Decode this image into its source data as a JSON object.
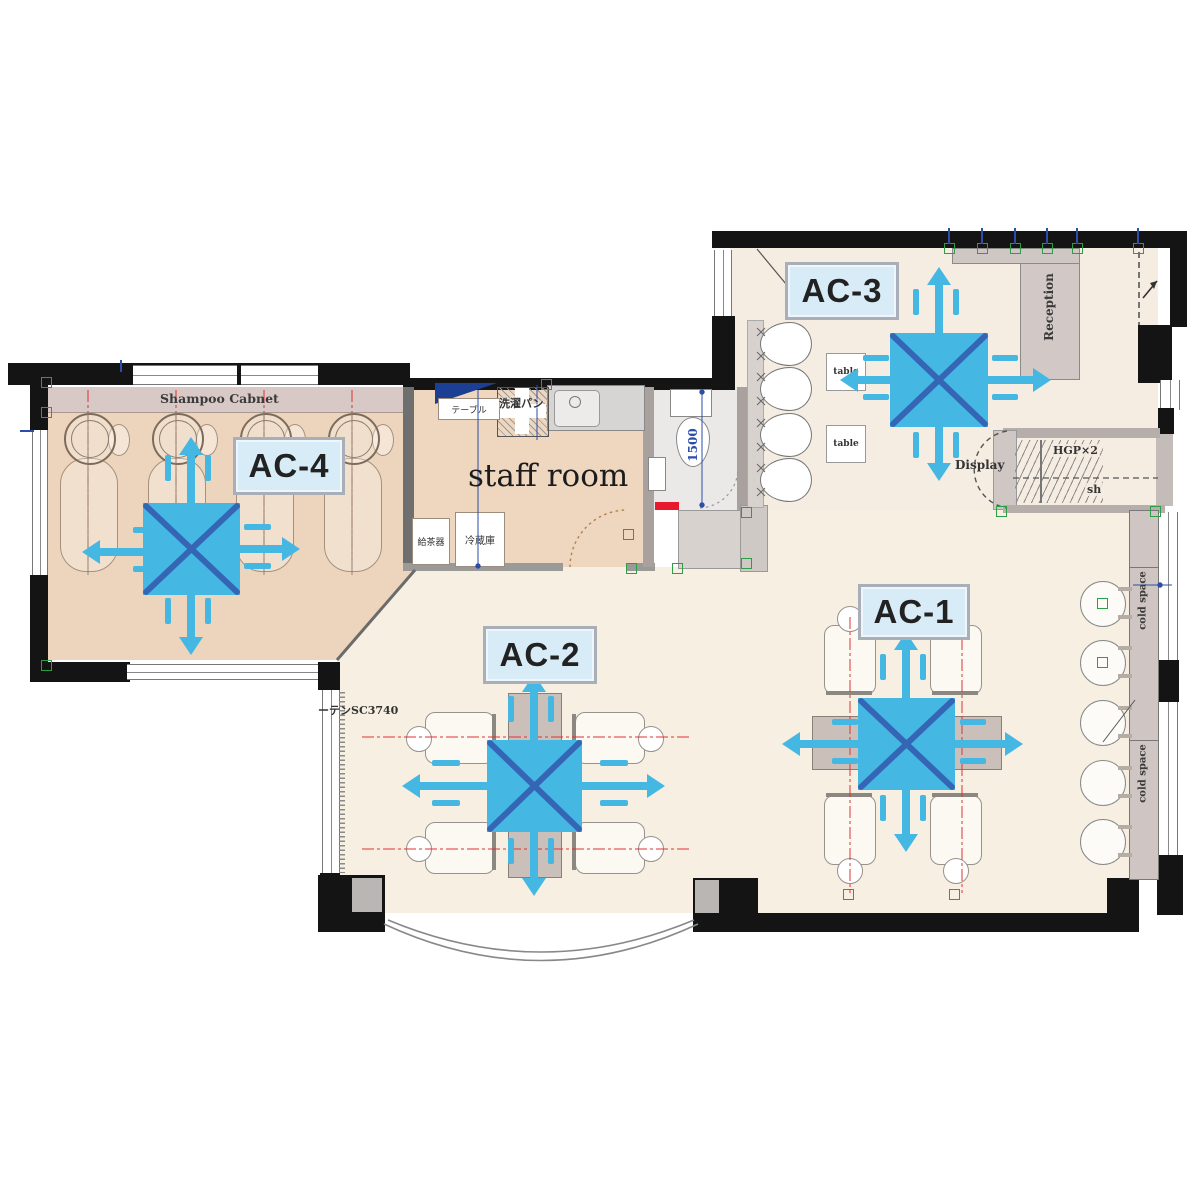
{
  "ac_units": [
    {
      "label": "AC-1"
    },
    {
      "label": "AC-2"
    },
    {
      "label": "AC-3"
    },
    {
      "label": "AC-4"
    }
  ],
  "rooms": {
    "shampoo_cabinet": "Shampoo Cabnet",
    "staff_room": "staff room"
  },
  "annotations": {
    "table_jp": "テーブル",
    "laundry_pan": "洗濯パン",
    "tea_server": "給茶器",
    "refrigerator": "冷蔵庫",
    "dim_1500": "1500",
    "table": "table",
    "reception": "Reception",
    "display": "Display",
    "hanger_pipe": "HGP×2",
    "shelf": "sh",
    "cold_space": "cold space",
    "curtain": "ーテンSC3740"
  },
  "legend": {
    "airflow_color": "#45b7e3",
    "unit_cross_color": "#3566b5",
    "ac_label_bg": "#d8ecf7",
    "wall_color": "#141414",
    "shampoo_room_floor": "#edd4bc",
    "main_floor": "#f7efe2",
    "cabinet_strip_color": "#d8c9c6",
    "toilet_floor": "#ebe9e8",
    "marker_green": "#2e9e46",
    "centerline_red": "#e03030",
    "dimension_blue": "#2b4ea8"
  }
}
